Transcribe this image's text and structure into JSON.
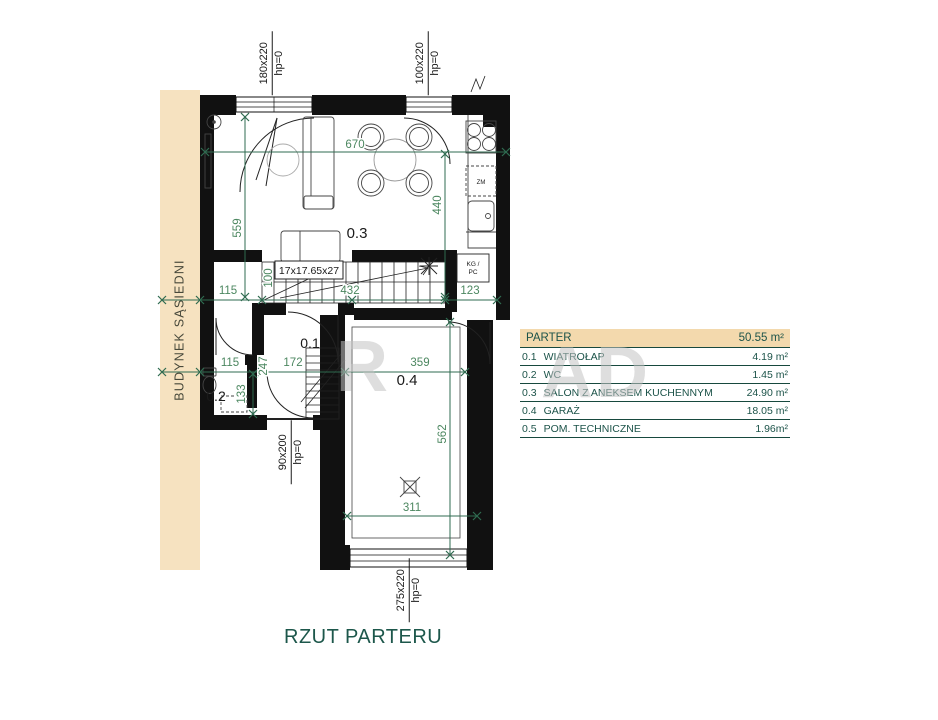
{
  "title": "RZUT PARTERU",
  "neighbor_label": "BUDYNEK SĄSIEDNI",
  "watermark": {
    "left": "R",
    "right": "AD"
  },
  "colors": {
    "dimension_green": "#4c8760",
    "dimension_line": "#2f6b50",
    "teal_text": "#1c5349",
    "neighbor_beige": "#f6e2c0",
    "legend_header_bg": "#f3d9ad",
    "wall_black": "#111111"
  },
  "plan": {
    "rooms": {
      "r01": "0.1",
      "r02": "0.2",
      "r03": "0.3",
      "r04": "0.4"
    },
    "stairs_label": "17x17.65x27",
    "boiler_line1": "KG /",
    "boiler_line2": "PC",
    "dishwasher_label": "ZM",
    "dims": {
      "living_width": "670",
      "living_height_left": "559",
      "living_height_right": "440",
      "hall_width": "115",
      "stair_depth": "100",
      "stair_length": "432",
      "tech_width": "123",
      "entry_width": "115",
      "vestibule_depth": "247",
      "vestibule_width": "172",
      "garage_width": "359",
      "wc_width": "133",
      "garage_depth": "562",
      "garage_door_span": "311"
    },
    "openings": [
      {
        "size": "180x220",
        "hp": "hp=0"
      },
      {
        "size": "100x220",
        "hp": "hp=0"
      },
      {
        "size": "90x200",
        "hp": "hp=0"
      },
      {
        "size": "275x220",
        "hp": "hp=0"
      }
    ]
  },
  "legend": {
    "header": {
      "label": "PARTER",
      "value": "50.55 m²"
    },
    "rows": [
      {
        "no": "0.1",
        "label": "WIATROŁAP",
        "value": "4.19 m²"
      },
      {
        "no": "0.2",
        "label": "WC",
        "value": "1.45 m²"
      },
      {
        "no": "0.3",
        "label": "SALON Z ANEKSEM KUCHENNYM",
        "value": "24.90 m²"
      },
      {
        "no": "0.4",
        "label": "GARAŻ",
        "value": "18.05 m²"
      },
      {
        "no": "0.5",
        "label": "POM. TECHNICZNE",
        "value": "1.96m²"
      }
    ]
  }
}
